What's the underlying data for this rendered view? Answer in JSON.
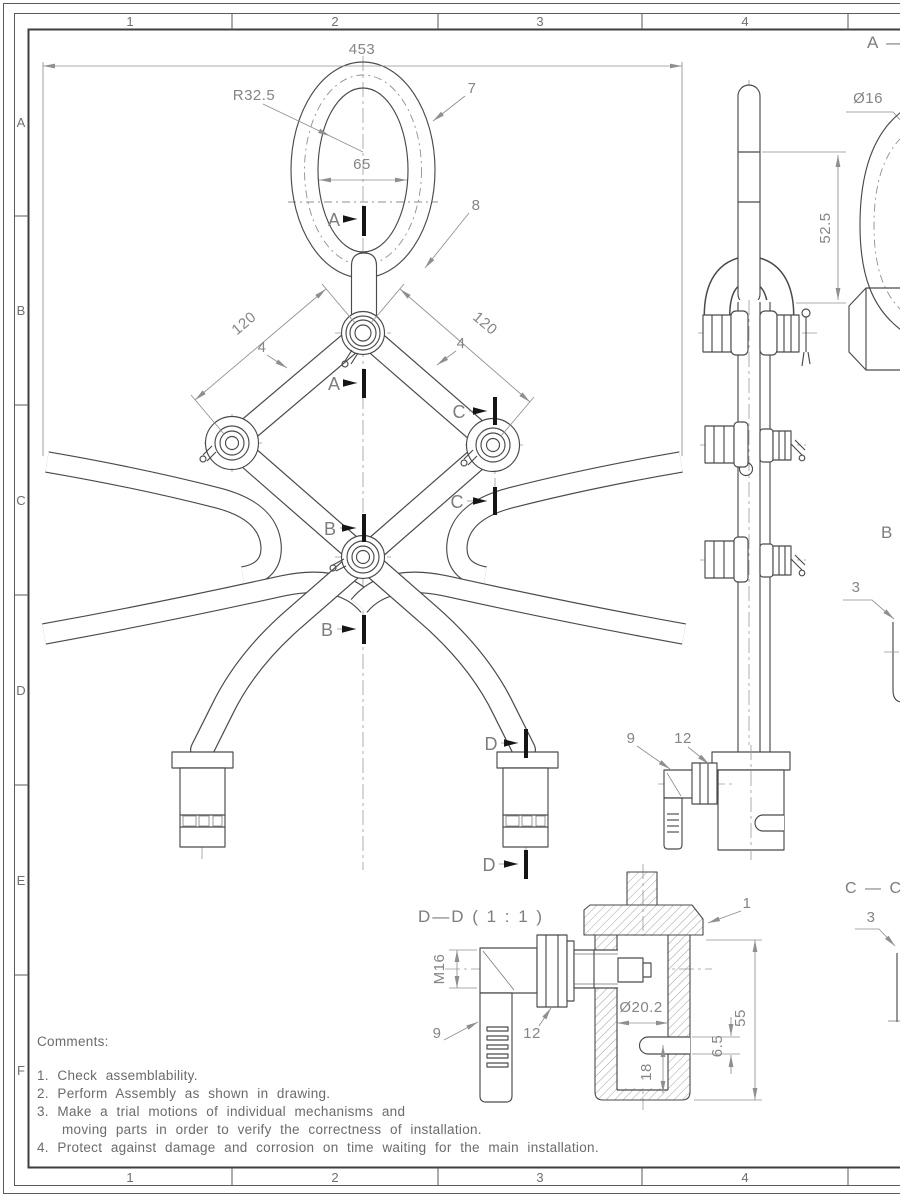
{
  "sheet": {
    "top_zones": [
      "1",
      "2",
      "3",
      "4"
    ],
    "bottom_zones": [
      "1",
      "2",
      "3",
      "4"
    ],
    "side_zones": [
      "A",
      "B",
      "C",
      "D",
      "E",
      "F"
    ]
  },
  "front_view": {
    "dims": {
      "overall_width": "453",
      "ring_radius": "R32.5",
      "ring_inner_width": "65",
      "arm_length_left": "120",
      "arm_length_right": "120",
      "arm_thickness_left": "4",
      "arm_thickness_right": "4"
    },
    "callouts": {
      "c7": "7",
      "c8": "8"
    },
    "sections": {
      "a": "A",
      "b": "B",
      "c": "C",
      "d": "D"
    }
  },
  "side_view": {
    "dims": {
      "pin_diameter": "Ø16",
      "link_length": "52.5"
    },
    "callouts": {
      "c9": "9",
      "c12": "12"
    }
  },
  "section_views": {
    "aa_label": "A — A",
    "bb_label": "B — B",
    "bb_callout_3": "3",
    "cc_label": "C — C",
    "cc_callout_3": "3",
    "dd_title": "D—D ( 1 : 1 )",
    "dd": {
      "callout_1": "1",
      "callout_9": "9",
      "callout_12": "12",
      "thread": "M16",
      "bore_diameter": "Ø20.2",
      "overall_height": "55",
      "slot_width": "6.5",
      "slot_offset": "18"
    }
  },
  "comments": {
    "heading": "Comments:",
    "lines": [
      "1. Check assemblability.",
      "2. Perform Assembly as shown in drawing.",
      "3. Make a trial motions of individual mechanisms and",
      "moving parts in order to verify the correctness of installation.",
      "4. Protect against damage and corrosion on time waiting for the main installation."
    ]
  }
}
